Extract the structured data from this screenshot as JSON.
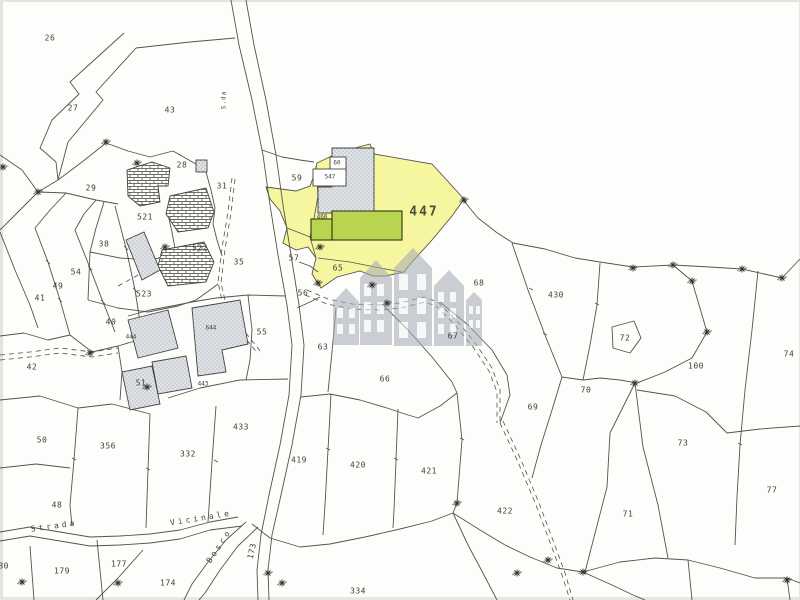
{
  "map": {
    "kind": "cadastral-parcel-map",
    "highlighted_parcel": "447"
  },
  "colors": {
    "paper": "#fdfdfb",
    "line": "#55524b",
    "label": "#3f3f39",
    "highlight_yellow": "#f5f69f",
    "building_green": "#b9d44f",
    "building_green_border": "#2e3a10",
    "building_gray": "#dfe3e7",
    "building_gray_dot": "#8d949c",
    "hatch_line": "#3f3f38",
    "watermark_gray": "#a6acb4"
  },
  "labels": {
    "parcels": [
      {
        "t": "26",
        "x": 50,
        "y": 38
      },
      {
        "t": "27",
        "x": 73,
        "y": 108
      },
      {
        "t": "43",
        "x": 170,
        "y": 110
      },
      {
        "t": "28",
        "x": 182,
        "y": 165
      },
      {
        "t": "31",
        "x": 222,
        "y": 186
      },
      {
        "t": "29",
        "x": 91,
        "y": 188
      },
      {
        "t": "521",
        "x": 145,
        "y": 217
      },
      {
        "t": "38",
        "x": 104,
        "y": 244
      },
      {
        "t": "522",
        "x": 200,
        "y": 248
      },
      {
        "t": "35",
        "x": 239,
        "y": 262
      },
      {
        "t": "54",
        "x": 76,
        "y": 272
      },
      {
        "t": "49",
        "x": 58,
        "y": 286
      },
      {
        "t": "41",
        "x": 40,
        "y": 298
      },
      {
        "t": "523",
        "x": 144,
        "y": 294
      },
      {
        "t": "40",
        "x": 111,
        "y": 322
      },
      {
        "t": "42",
        "x": 32,
        "y": 367
      },
      {
        "t": "444",
        "x": 131,
        "y": 337,
        "s": 6
      },
      {
        "t": "644",
        "x": 211,
        "y": 328,
        "s": 6
      },
      {
        "t": "55",
        "x": 262,
        "y": 332
      },
      {
        "t": "51",
        "x": 141,
        "y": 383
      },
      {
        "t": "443",
        "x": 203,
        "y": 384,
        "s": 6
      },
      {
        "t": "50",
        "x": 42,
        "y": 440
      },
      {
        "t": "356",
        "x": 108,
        "y": 446
      },
      {
        "t": "332",
        "x": 188,
        "y": 454
      },
      {
        "t": "433",
        "x": 241,
        "y": 427
      },
      {
        "t": "48",
        "x": 57,
        "y": 505
      },
      {
        "t": "180",
        "x": 1,
        "y": 566
      },
      {
        "t": "179",
        "x": 62,
        "y": 571
      },
      {
        "t": "177",
        "x": 119,
        "y": 564
      },
      {
        "t": "174",
        "x": 168,
        "y": 583
      },
      {
        "t": "173",
        "x": 252,
        "y": 551,
        "r": -78
      },
      {
        "t": "59",
        "x": 297,
        "y": 178
      },
      {
        "t": "60",
        "x": 337,
        "y": 163,
        "s": 6
      },
      {
        "t": "547",
        "x": 330,
        "y": 177,
        "s": 6
      },
      {
        "t": "460",
        "x": 322,
        "y": 217,
        "s": 6
      },
      {
        "t": "447",
        "x": 424,
        "y": 212,
        "big": true
      },
      {
        "t": "57",
        "x": 294,
        "y": 258
      },
      {
        "t": "65",
        "x": 338,
        "y": 268
      },
      {
        "t": "56",
        "x": 303,
        "y": 293
      },
      {
        "t": "68",
        "x": 479,
        "y": 283
      },
      {
        "t": "63",
        "x": 323,
        "y": 347
      },
      {
        "t": "66",
        "x": 385,
        "y": 379
      },
      {
        "t": "67",
        "x": 453,
        "y": 336
      },
      {
        "t": "430",
        "x": 556,
        "y": 295
      },
      {
        "t": "72",
        "x": 625,
        "y": 338
      },
      {
        "t": "100",
        "x": 696,
        "y": 366
      },
      {
        "t": "74",
        "x": 789,
        "y": 354
      },
      {
        "t": "70",
        "x": 586,
        "y": 390
      },
      {
        "t": "69",
        "x": 533,
        "y": 407
      },
      {
        "t": "73",
        "x": 683,
        "y": 443
      },
      {
        "t": "77",
        "x": 772,
        "y": 490
      },
      {
        "t": "71",
        "x": 628,
        "y": 514
      },
      {
        "t": "422",
        "x": 505,
        "y": 511
      },
      {
        "t": "419",
        "x": 299,
        "y": 460
      },
      {
        "t": "420",
        "x": 358,
        "y": 465
      },
      {
        "t": "421",
        "x": 429,
        "y": 471
      },
      {
        "t": "334",
        "x": 358,
        "y": 591
      }
    ],
    "roads": [
      {
        "t": "Strada",
        "x": 54,
        "y": 526,
        "r": -8
      },
      {
        "t": "Vicinale",
        "x": 201,
        "y": 518,
        "r": -9
      },
      {
        "t": "Bosco",
        "x": 219,
        "y": 546,
        "r": -57
      },
      {
        "t": "S.da",
        "x": 224,
        "y": 100,
        "r": -90,
        "tiny": true
      }
    ]
  },
  "markers": {
    "survey_cross_positions": [
      [
        106,
        142
      ],
      [
        3,
        167
      ],
      [
        38,
        192
      ],
      [
        137,
        163
      ],
      [
        165,
        247
      ],
      [
        90,
        353
      ],
      [
        147,
        387
      ],
      [
        320,
        247
      ],
      [
        318,
        283
      ],
      [
        372,
        285
      ],
      [
        387,
        303
      ],
      [
        464,
        200
      ],
      [
        633,
        268
      ],
      [
        673,
        265
      ],
      [
        742,
        269
      ],
      [
        782,
        278
      ],
      [
        692,
        281
      ],
      [
        707,
        332
      ],
      [
        635,
        383
      ],
      [
        548,
        560
      ],
      [
        517,
        573
      ],
      [
        583,
        572
      ],
      [
        457,
        503
      ],
      [
        282,
        583
      ],
      [
        268,
        573
      ],
      [
        22,
        582
      ],
      [
        118,
        583
      ],
      [
        787,
        580
      ]
    ]
  }
}
